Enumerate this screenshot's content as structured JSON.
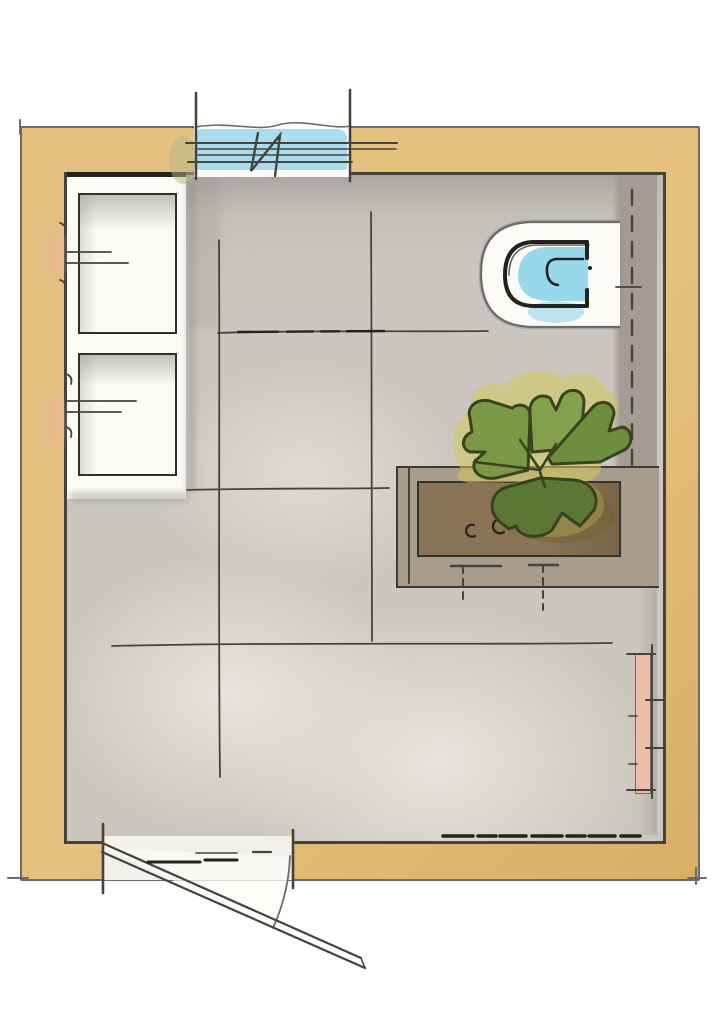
{
  "meta": {
    "kind": "hand-drawn watercolor floor plan",
    "room": "bathroom"
  },
  "palette": {
    "paper": "#ffffff",
    "wall": "#e5c07e",
    "wall-deep": "#d9af66",
    "ink": "#45433c",
    "ink-strong": "#23221e",
    "ink-soft": "#6e6b63",
    "floor": "#cbc7c0",
    "floor-light": "#e7e4de",
    "prewall": "#a49b92",
    "counter": "#a89c8c",
    "counter-line": "#3c3a32",
    "soil": "#8b7355",
    "leaf": "#7b9847",
    "leaf-light": "#85a04c",
    "leaf-mid": "#6f8e3d",
    "leaf-dark": "#5b7733",
    "leaf-outline": "#39431f",
    "glow": "#d2c85a",
    "glass": "#a9dcee",
    "water": "#93d5ea",
    "fixture": "#fcfbf7",
    "radiator": "#eebcab",
    "blush": "#e8b39c"
  },
  "elements": {
    "window": {
      "name": "window",
      "glazing_lines": 3
    },
    "toilet": {
      "name": "wall-hung toilet"
    },
    "prewall": {
      "name": "installation wall"
    },
    "planter": {
      "name": "planter bench"
    },
    "plant": {
      "name": "leafy plant"
    },
    "radiator": {
      "name": "radiator"
    },
    "door": {
      "name": "hinged door with swing arc"
    },
    "storage": {
      "name": "stacked storage units",
      "count": 2
    },
    "floor": {
      "name": "tiled floor",
      "tile_joint_lines": 5
    }
  }
}
